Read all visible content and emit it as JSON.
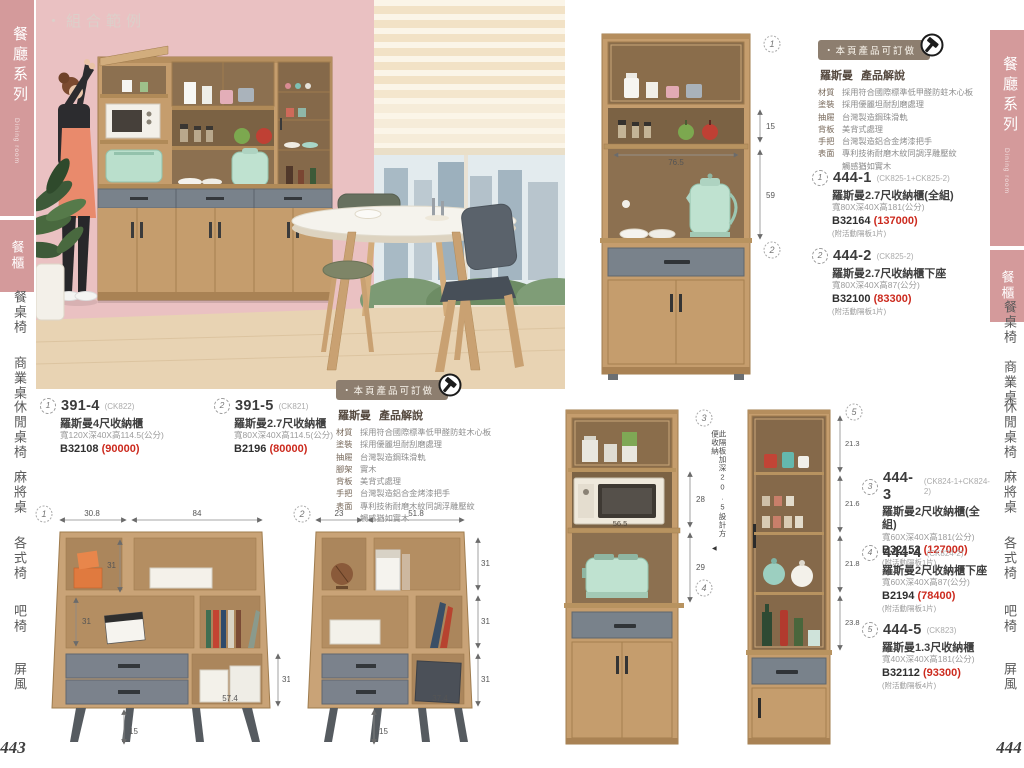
{
  "sidebar": {
    "series_title": "餐廳系列",
    "series_subtitle": "Dining room",
    "active_category": "餐櫃",
    "items": [
      "餐桌椅",
      "商業桌",
      "休閒桌椅",
      "麻將桌",
      "各式椅",
      "吧椅",
      "屏風"
    ],
    "page_number_left": "443",
    "page_number_right": "444"
  },
  "photo": {
    "label": "・組合範例"
  },
  "order_badge": "・本頁產品可訂做",
  "spec_left": {
    "brand": "羅斯曼",
    "title": "產品解說",
    "rows": [
      {
        "label": "材質",
        "value": "採用符合國際標準低甲醛防蛀木心板"
      },
      {
        "label": "塗裝",
        "value": "採用優麗坦耐刮磨處理"
      },
      {
        "label": "抽屜",
        "value": "台灣製造鋼珠滑軌"
      },
      {
        "label": "腳架",
        "value": "實木"
      },
      {
        "label": "背板",
        "value": "美背式處理"
      },
      {
        "label": "手把",
        "value": "台灣製造鋁合金烤漆把手"
      },
      {
        "label": "表面",
        "value": "專利技術耐磨木紋同調浮雕壓紋"
      },
      {
        "label": "",
        "value": "觸感猶如實木"
      }
    ]
  },
  "spec_right": {
    "brand": "羅斯曼",
    "title": "產品解說",
    "rows": [
      {
        "label": "材質",
        "value": "採用符合國際標準低甲醛防蛀木心板"
      },
      {
        "label": "塗裝",
        "value": "採用優麗坦耐刮磨處理"
      },
      {
        "label": "抽屜",
        "value": "台灣製造鋼珠滑軌"
      },
      {
        "label": "背板",
        "value": "美背式處理"
      },
      {
        "label": "手把",
        "value": "台灣製造鋁合金烤漆把手"
      },
      {
        "label": "表面",
        "value": "專利技術耐磨木紋同調浮雕壓紋"
      },
      {
        "label": "",
        "value": "觸感猶如實木"
      }
    ]
  },
  "products": {
    "p391_4": {
      "num": "1",
      "model": "391-4",
      "code": "(CK822)",
      "name": "羅斯曼4尺收納櫃",
      "dims": "寬120X深40X高114.5(公分)",
      "sku": "B32108",
      "price": "(90000)"
    },
    "p391_5": {
      "num": "2",
      "model": "391-5",
      "code": "(CK821)",
      "name": "羅斯曼2.7尺收納櫃",
      "dims": "寬80X深40X高114.5(公分)",
      "sku": "B2196",
      "price": "(80000)"
    },
    "p444_1": {
      "num": "1",
      "model": "444-1",
      "code": "(CK825-1+CK825-2)",
      "name": "羅斯曼2.7尺收納櫃(全組)",
      "dims": "寬80X深40X高181(公分)",
      "sku": "B32164",
      "price": "(137000)",
      "note": "(附活動隔板1片)"
    },
    "p444_2": {
      "num": "2",
      "model": "444-2",
      "code": "(CK825-2)",
      "name": "羅斯曼2.7尺收納櫃下座",
      "dims": "寬80X深40X高87(公分)",
      "sku": "B32100",
      "price": "(83300)",
      "note": "(附活動隔板1片)"
    },
    "p444_3": {
      "num": "3",
      "model": "444-3",
      "code": "(CK824-1+CK824-2)",
      "name": "羅斯曼2尺收納櫃(全組)",
      "dims": "寬60X深40X高181(公分)",
      "sku": "B32152",
      "price": "(127000)",
      "note": "(附活動隔板1片)"
    },
    "p444_4": {
      "num": "4",
      "model": "444-4",
      "code": "(CK824-2)",
      "name": "羅斯曼2尺收納櫃下座",
      "dims": "寬60X深40X高87(公分)",
      "sku": "B2194",
      "price": "(78400)",
      "note": "(附活動隔板1片)"
    },
    "p444_5": {
      "num": "5",
      "model": "444-5",
      "code": "(CK823)",
      "name": "羅斯曼1.3尺收納櫃",
      "dims": "寬40X深40X高181(公分)",
      "sku": "B32112",
      "price": "(93300)",
      "note": "(附活動隔板4片)"
    }
  },
  "dims": {
    "d1": {
      "num": "1",
      "w1": "30.8",
      "w2": "84",
      "h1": "31",
      "h2": "31",
      "h3": "31",
      "bw": "57.4",
      "leg": "15"
    },
    "d2": {
      "num": "2",
      "w1": "23",
      "w2": "51.8",
      "h1": "31",
      "h2": "31",
      "h3": "31",
      "bw": "37.4",
      "leg": "15"
    },
    "hutch": {
      "num_top": "1",
      "num_bottom": "2",
      "gap": "15",
      "opening": "59",
      "inner": "76.5"
    },
    "unit2": {
      "num_top": "3",
      "num_bottom": "4",
      "mw": "56.5",
      "h1": "28",
      "h2": "29",
      "annotation": "此隔板加深20.5設計方便收納",
      "pointer": "◀"
    },
    "unit13": {
      "num": "5",
      "s1": "21.3",
      "s2": "21.6",
      "s3": "21.8",
      "s4": "23.8"
    }
  },
  "colors": {
    "accent_pink": "#d49a9b",
    "price_red": "#cc2a1e",
    "wood": "#c59d6d",
    "drawer_gray": "#79828b",
    "badge_taupe": "#8d7e6f"
  }
}
